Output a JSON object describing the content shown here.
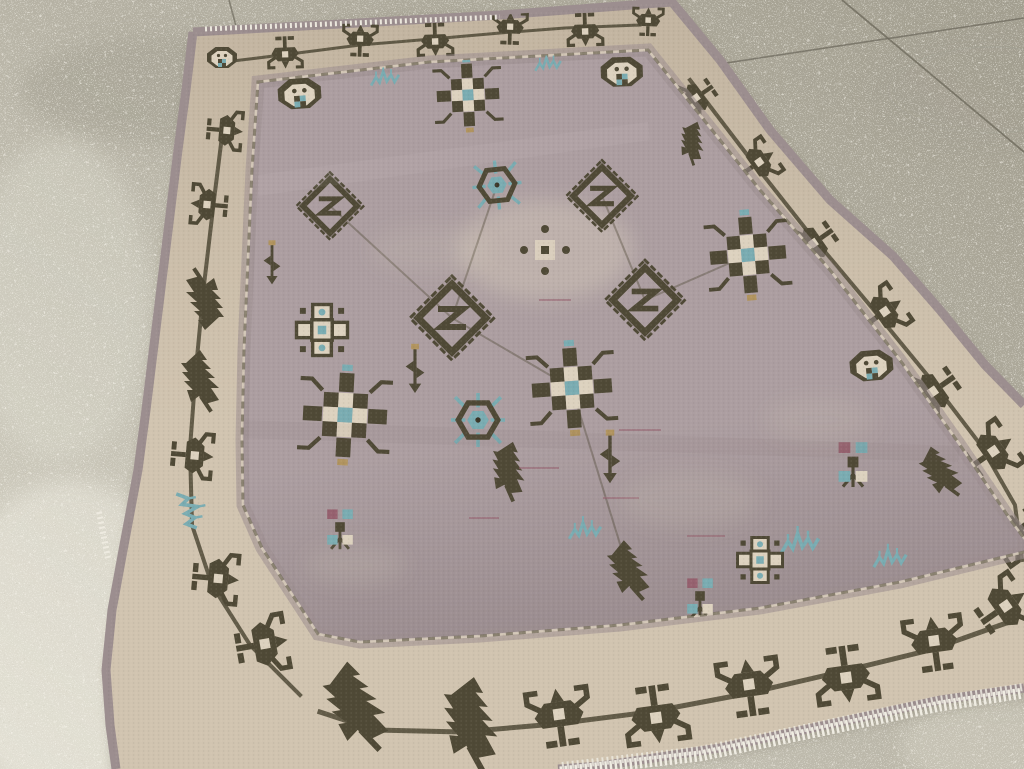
{
  "scene": {
    "title": "Vintage geometric tribal rug on a speckled concrete floor",
    "description": "High-angle oblique photograph of a worn vintage hand-knotted rug (Heriz/Karaja style) lying on a light speckled concrete showroom floor. The rug has a muted mauve-grey field covered with dark olive geometric motifs (hooked diamonds, checkerboard crosses, octagon rosettes, serrated leaves, small flowers) with steel-blue, plum and tan accents, a cream main border with dark hooked palmettes joined by an angular vine, narrow mauve guard stripes, and a white fringe visible along the top edge and lower-right edge. Faint expansion-joint seam lines cross the floor at the upper right; the floor brightens toward the lower left. No text appears in the image.",
    "setting": "indoor concrete floor, daylight"
  },
  "floor": {
    "material": "speckled concrete / terrazzo",
    "seam_count": 3,
    "appearance": "fine white aggregate speckle, brighter and coarser at lower left, darker greenish at upper right"
  },
  "rug": {
    "style": "geometric tribal, all-over repeat with diamond medallions",
    "pile": "low, evenly worn",
    "field_ground": "mauve-grey",
    "border_ground": "cream-bone",
    "border_design": "large dark hooked palmettes and serrated leaves on an angular vine",
    "guard_stripes": "narrow mauve bands with small dark ticks",
    "fringe": "short white cotton fringe on top edge and lower-right edge",
    "motifs": [
      "hooked-diamond-with-Z",
      "checkerboard-cross",
      "octagon-rosette",
      "hexagon-medallion",
      "serrated-leaf",
      "quatrefoil-medallion",
      "small-four-petal-flower",
      "arrow-sprig",
      "teal-zigzag-sprig",
      "central-cream-sunburst"
    ]
  },
  "palette": {
    "floorBase": "#b4b0a2",
    "floorLight": "#d8d5c8",
    "floorDark": "#a29e8f",
    "seam": "#6e6a5d",
    "edging": "#9c8e8f",
    "borderGround": "#d1c4b0",
    "borderGroundDark": "#c2b4a0",
    "field": "#ac9ea1",
    "fieldDark": "#9c8e91",
    "motif": "#4f4936",
    "motifDark": "#3b3628",
    "teal": "#7aacb2",
    "tealLight": "#a9cbcd",
    "plum": "#96616f",
    "tan": "#b1945f",
    "cream": "#ddd2bf",
    "fringe": "#efece2",
    "shadow": "#46402f"
  }
}
